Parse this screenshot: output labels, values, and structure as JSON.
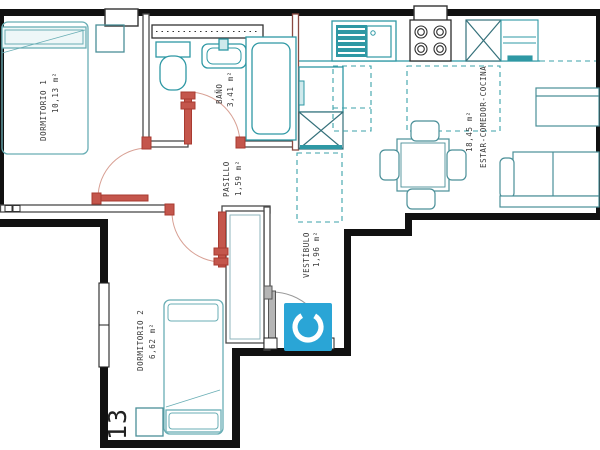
{
  "plan": {
    "title": "apartment-floor-plan",
    "rooms": [
      {
        "name": "DORMITORIO 1",
        "area": "10,13 m²"
      },
      {
        "name": "BAÑO",
        "area": "3,41 m²"
      },
      {
        "name": "PASILLO",
        "area": "1,59 m²"
      },
      {
        "name": "VESTÍBULO",
        "area": "1,96 m²"
      },
      {
        "name": "DORMITORIO 2",
        "area": "6,62 m²"
      },
      {
        "name": "ESTAR-COMEDOR-COCINA",
        "area": "18,45 m²"
      }
    ],
    "plot_number": "13",
    "logo": {
      "letter": "C",
      "color": "#2AA5D6"
    },
    "colors": {
      "outer_wall": "#111111",
      "interior_wall": "#4a4a4a",
      "bath_wall": "#8b4a42",
      "fixture_teal": "#2E98A4",
      "furniture_teal": "#5FA6AF",
      "door_red": "#A93B31",
      "door_arc": "#D8A094",
      "entry_gray": "#8a8a8a",
      "dashed_teal": "#3BA2AA",
      "label_text": "#3A3A3A"
    }
  }
}
